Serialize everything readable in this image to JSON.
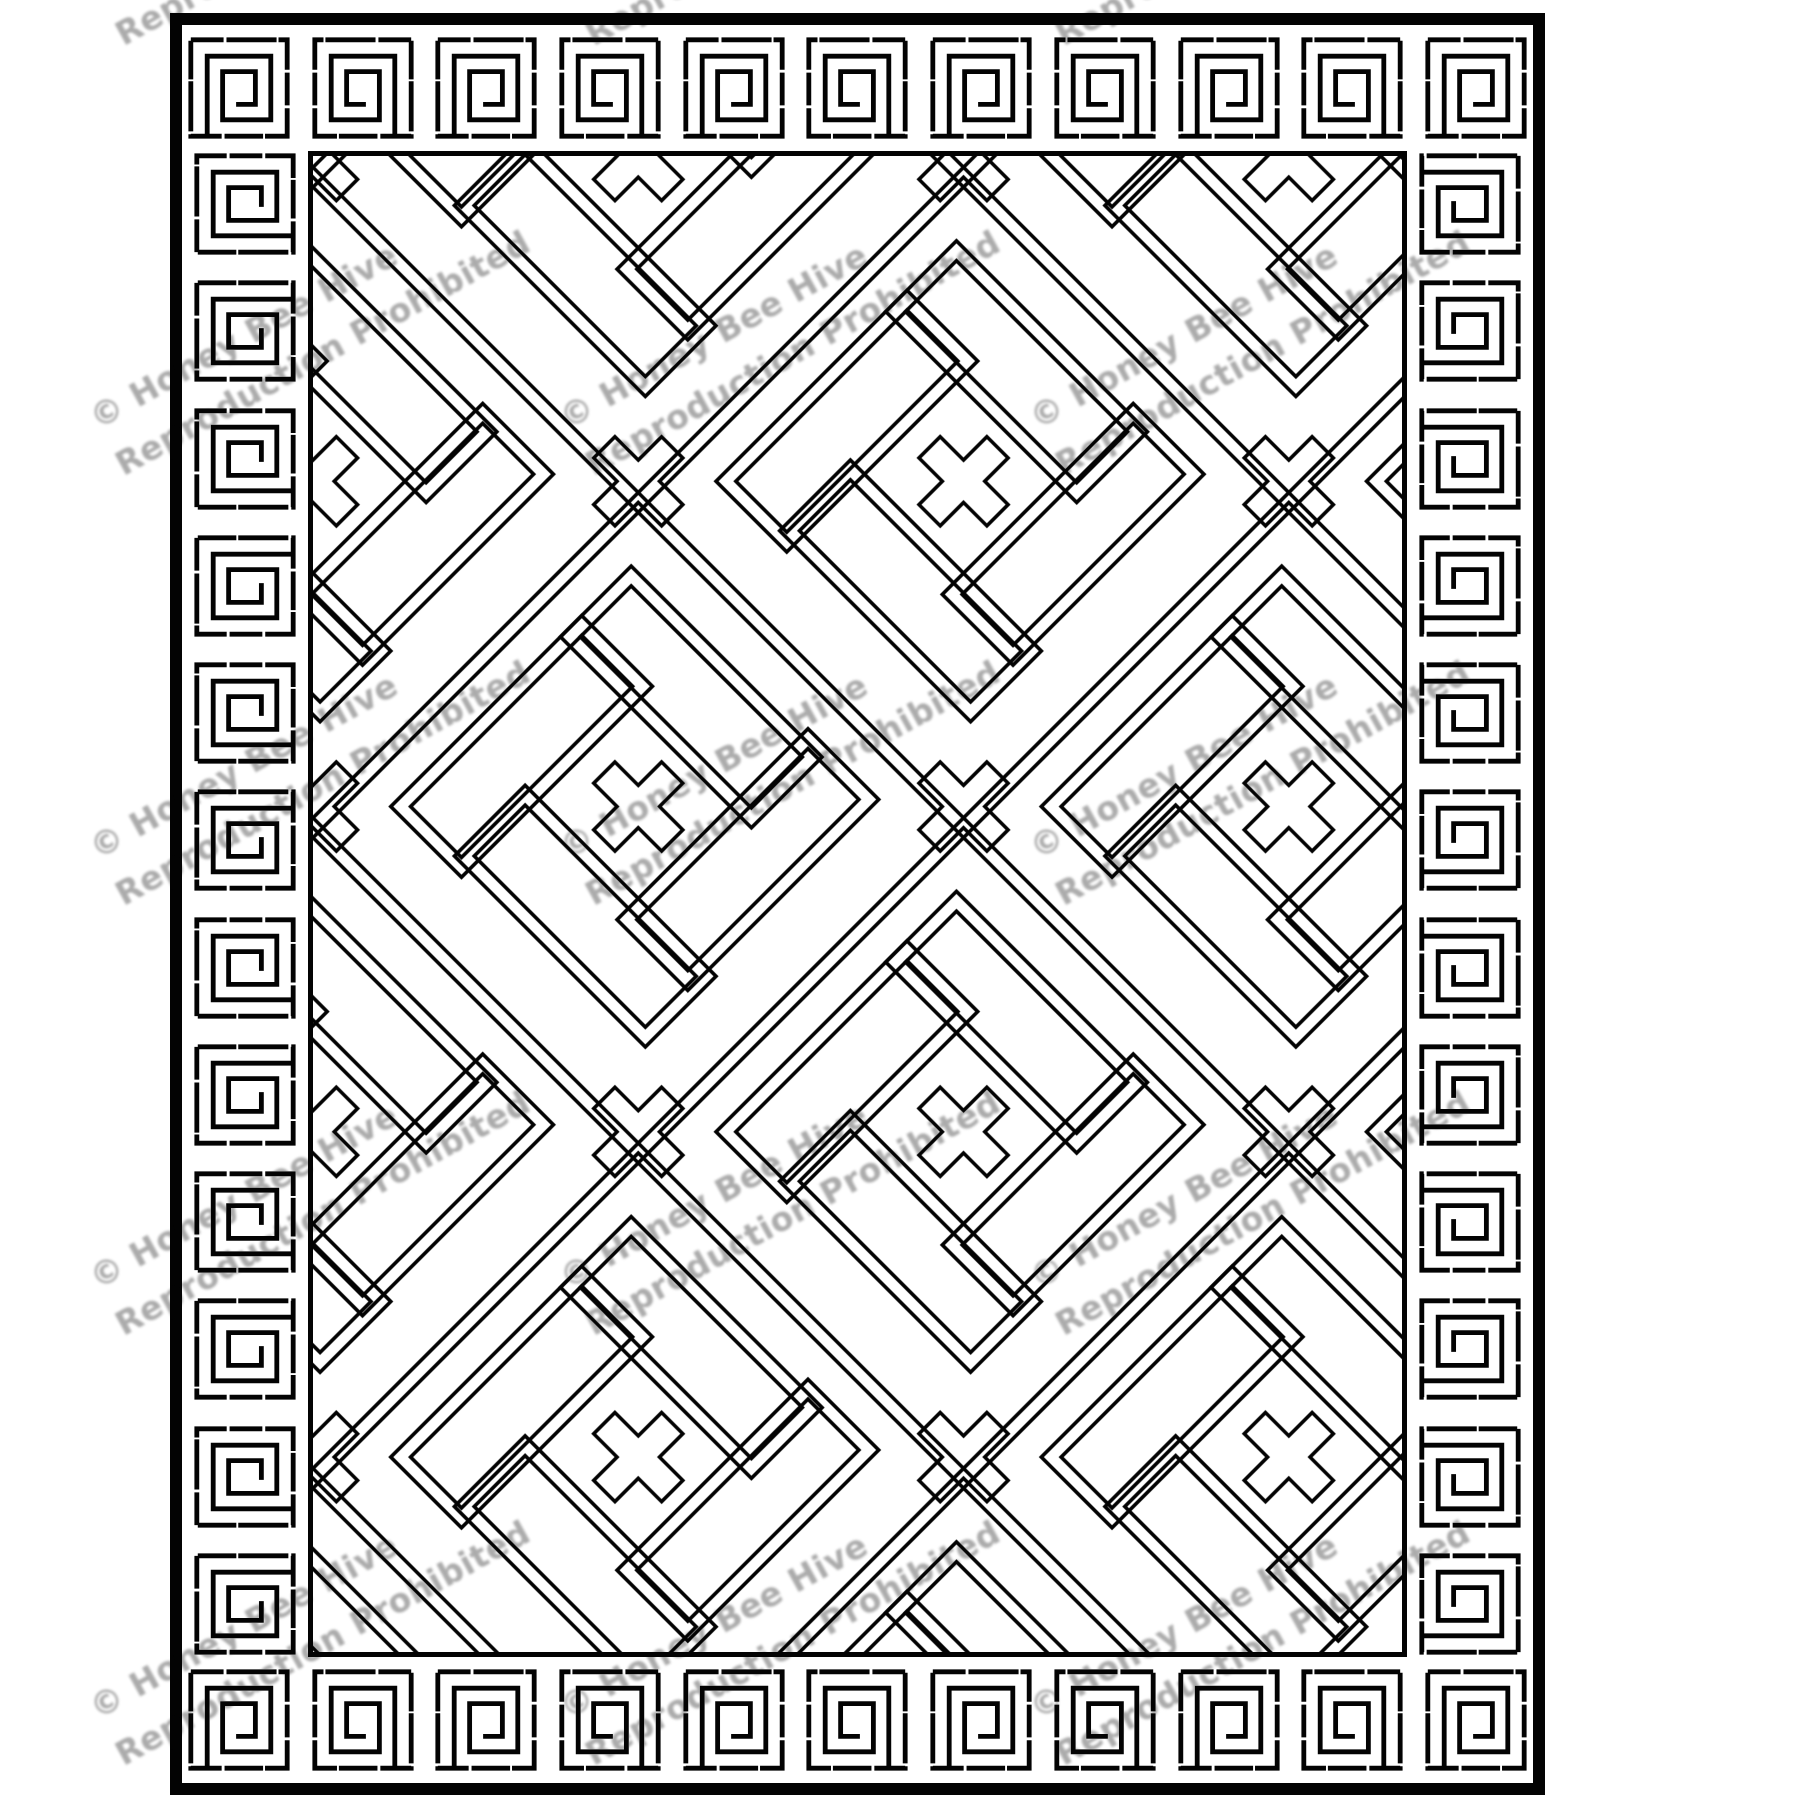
{
  "artwork": {
    "kind": "rug-hooking-pattern-line-drawing",
    "ink_color": "#030303",
    "paper_color": "#ffffff",
    "border_motif": "greek-key-meander",
    "field_motif": "interlocking-diagonal-lattice-with-stepped-crosses",
    "border_counts": {
      "top": 11,
      "bottom": 11,
      "left": 12,
      "right": 12
    }
  },
  "watermark": {
    "line1": "© Honey Bee Hive",
    "line2": "Reproduction Prohibited",
    "color": "#9d9d9d"
  }
}
